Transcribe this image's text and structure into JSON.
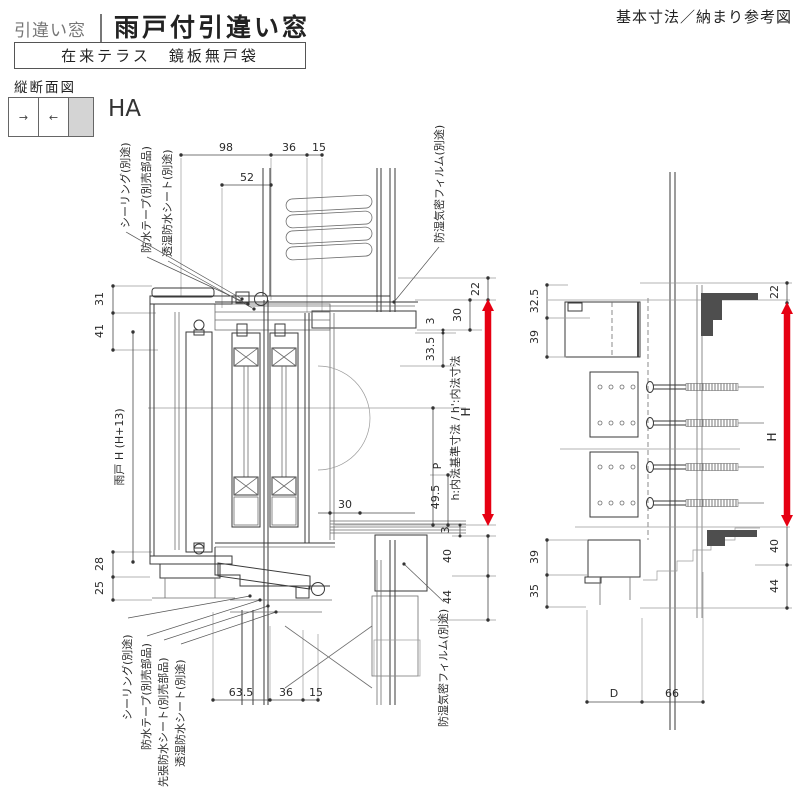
{
  "header": {
    "category": "引違い窓",
    "title": "雨戸付引違い窓",
    "note": "基本寸法／納まり参考図",
    "subtitle": "在来テラス　鏡板無戸袋"
  },
  "view": {
    "label": "縦断面図",
    "window_type": "HA",
    "arrow_right_glyph": "→",
    "arrow_left_glyph": "←"
  },
  "main": {
    "labels": {
      "top": [
        "シーリング(別途)",
        "防水テープ(別売部品)",
        "透湿防水シート(別途)",
        "防湿気密フィルム(別途)"
      ],
      "bottom": [
        "シーリング(別途)",
        "防水テープ(別売部品)",
        "先張防水シート(別売部品)",
        "透湿防水シート(別途)",
        "防湿気密フィルム(別途)"
      ],
      "shutter_height": "雨戸 H (H+13)",
      "inner_axis": "h:内法基準寸法 / h':内法寸法",
      "height_arrow": "H"
    },
    "dims": {
      "top": [
        "98",
        "52",
        "36",
        "15"
      ],
      "bottom": [
        "63.5",
        "36",
        "15"
      ],
      "left": [
        "31",
        "41",
        "28",
        "25"
      ],
      "right": [
        "22",
        "30",
        "3",
        "33.5",
        "P",
        "49.5",
        "3",
        "40",
        "44"
      ],
      "inner": "30"
    }
  },
  "side": {
    "labels": {
      "height_arrow": "H"
    },
    "dims": {
      "left_top": [
        "32.5",
        "39"
      ],
      "left_bottom": [
        "39",
        "35"
      ],
      "right": [
        "22",
        "40",
        "44"
      ],
      "bottom": [
        "D",
        "66"
      ]
    }
  },
  "colors": {
    "accent": "#e60012",
    "line": "#3a3a3a",
    "line_light": "#9a9a9a",
    "pane_gray": "#d4d4d4"
  }
}
